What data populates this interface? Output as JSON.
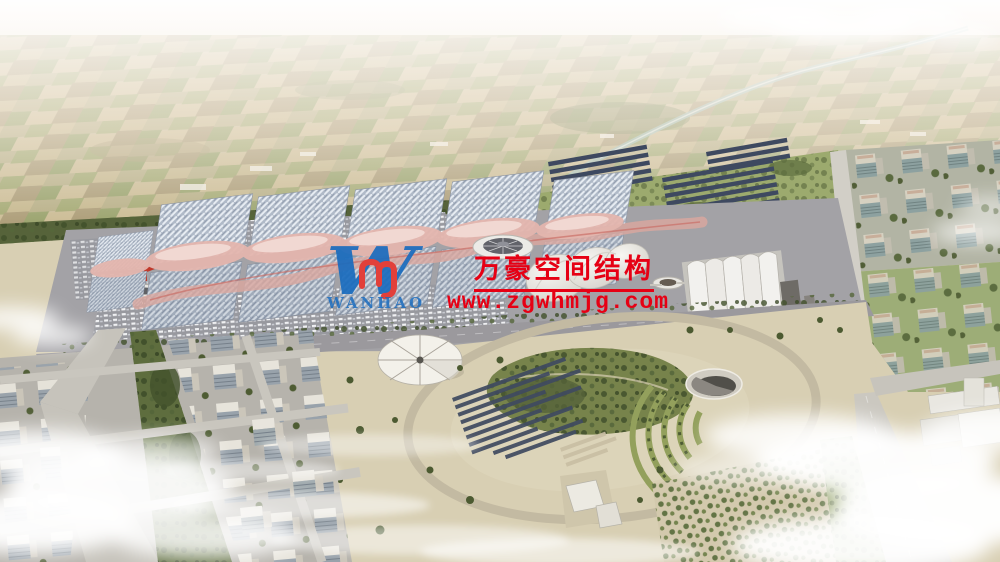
{
  "watermark": {
    "company_name_cn": "万豪空间结构",
    "website": "www.zgwhmjg.com",
    "text_red": "#e60014",
    "logo": {
      "letter": "W",
      "subtext": "WANHAO",
      "blue": "#1a6cbe",
      "monogram_red": "#e2403a"
    }
  },
  "scene": {
    "palette": {
      "sky_haze": "#f3ece2",
      "farmland": "#c9ba97",
      "vegetation": "#5e6d3e",
      "expo_roof_glass": "#aeb8c6",
      "membrane_pink": "#e4b6ae",
      "concrete": "#a3a2a6",
      "park_ground": "#d8cfb3",
      "solar_panel": "#3f4a60",
      "water": "#9fbfba",
      "cloud": "#ffffff"
    }
  }
}
